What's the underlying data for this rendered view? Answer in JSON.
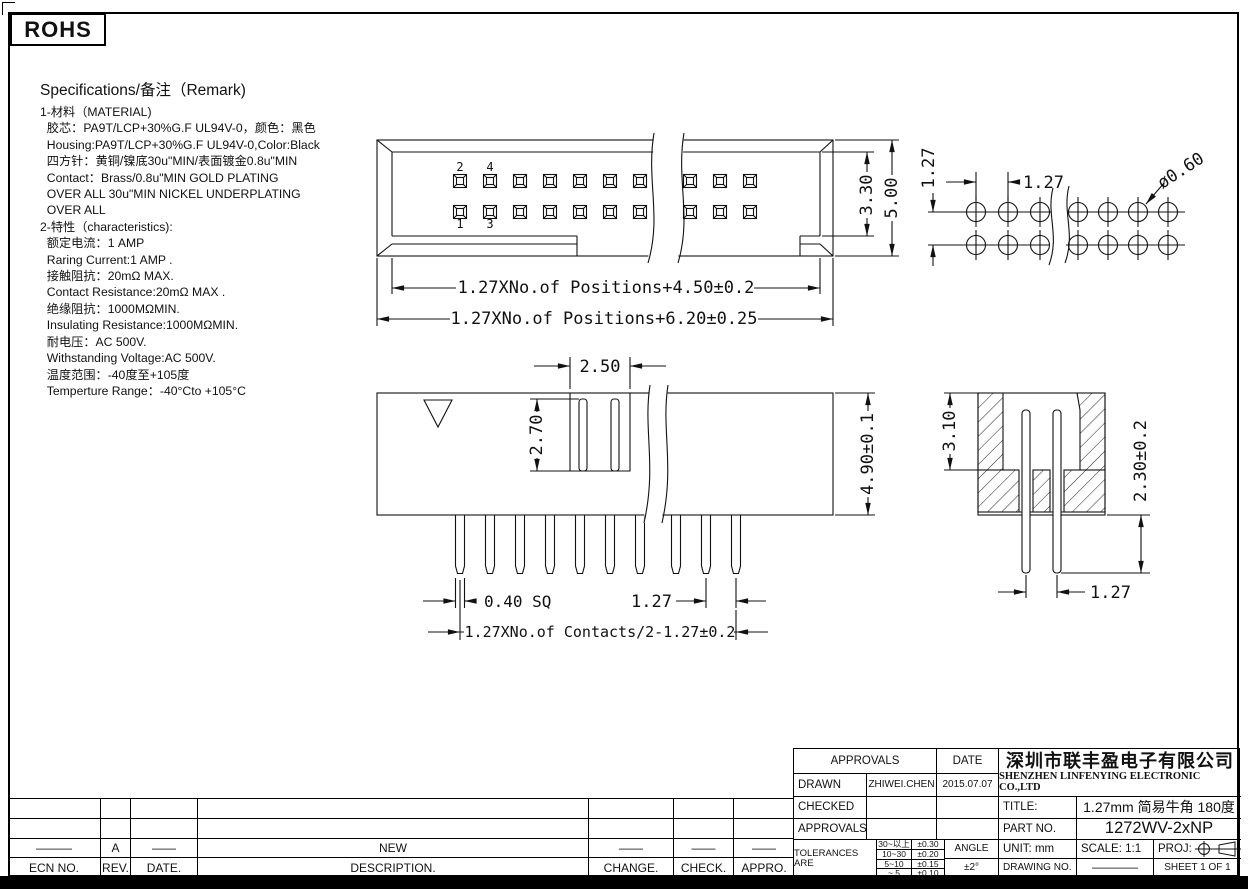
{
  "page": {
    "rohs": "ROHS"
  },
  "specs": {
    "title": "Specifications/备注（Remark)",
    "lines": [
      "1-材料（MATERIAL)",
      "  胶芯：PA9T/LCP+30%G.F UL94V-0，颜色：黑色",
      "  Housing:PA9T/LCP+30%G.F UL94V-0,Color:Black",
      "  四方针：黄铜/镍底30u\"MIN/表面镀金0.8u\"MIN",
      "  Contact：Brass/0.8u\"MIN GOLD PLATING",
      "  OVER ALL 30u\"MIN NICKEL UNDERPLATING",
      "  OVER ALL",
      "2-特性（characteristics):",
      "  额定电流：1 AMP",
      "  Raring Current:1 AMP .",
      "  接触阻抗：20mΩ MAX.",
      "  Contact Resistance:20mΩ MAX .",
      "  绝缘阻抗：1000MΩMIN.",
      "  Insulating Resistance:1000MΩMIN.",
      "  耐电压：AC 500V.",
      "  Withstanding Voltage:AC 500V.",
      "  温度范围：-40度至+105度",
      "  Temperture Range：-40°Cto +105°C"
    ]
  },
  "views": {
    "top_view": {
      "pin_numbers": [
        "2",
        "4",
        "1",
        "3"
      ],
      "dims": {
        "inner_width": "1.27XNo.of Positions+4.50±0.2",
        "outer_width": "1.27XNo.of Positions+6.20±0.25",
        "inner_height": "3.30",
        "outer_height": "5.00"
      }
    },
    "hole_pattern": {
      "dims": {
        "row_pitch": "1.27",
        "col_pitch": "1.27",
        "hole_dia": "ø0.60"
      }
    },
    "front_view": {
      "dims": {
        "slot_width": "2.50",
        "slot_depth": "2.70",
        "body_height": "4.90±0.1",
        "pin_square": "0.40 SQ",
        "pin_pitch": "1.27",
        "span": "1.27XNo.of Contacts/2-1.27±0.2"
      }
    },
    "section_view": {
      "dims": {
        "cavity_depth": "3.10",
        "pin_length": "2.30±0.2",
        "pin_pitch": "1.27"
      }
    }
  },
  "revision_table": {
    "headers": [
      "ECN  NO.",
      "REV.",
      "DATE.",
      "DESCRIPTION.",
      "CHANGE.",
      "CHECK.",
      "APPRO."
    ],
    "rows": [
      [
        "",
        "",
        "",
        "",
        "",
        "",
        ""
      ],
      [
        "",
        "",
        "",
        "",
        "",
        "",
        ""
      ],
      [
        "———",
        "A",
        "——",
        "NEW",
        "——",
        "——",
        "——"
      ]
    ]
  },
  "title_block": {
    "approvals_header": "APPROVALS",
    "date_header": "DATE",
    "drawn_label": "DRAWN",
    "drawn_by": "ZHIWEI.CHEN",
    "drawn_date": "2015.07.07",
    "checked_label": "CHECKED",
    "approvals_label": "APPROVALS",
    "tolerances_label": "TOLERANCES ARE",
    "tolerance_rows": [
      [
        "30~以上",
        "±0.30"
      ],
      [
        "10~30",
        "±0.20"
      ],
      [
        "5~10",
        "±0.15"
      ],
      [
        "~ 5",
        "±0.10"
      ]
    ],
    "angle_label": "ANGLE",
    "angle_value": "±2°",
    "company_cn": "深圳市联丰盈电子有限公司",
    "company_en": "SHENZHEN LINFENYING ELECTRONIC CO.,LTD",
    "title_label": "TITLE:",
    "title_value": "1.27mm 简易牛角 180度",
    "part_no_label": "PART  NO.",
    "part_no_value": "1272WV-2xNP",
    "unit_label": "UNIT:  mm",
    "scale_label": "SCALE:   1:1",
    "proj_label": "PROJ:",
    "drawing_no_label": "DRAWING  NO.",
    "drawing_no_value": "————",
    "sheet_label": "SHEET   1  OF  1"
  }
}
